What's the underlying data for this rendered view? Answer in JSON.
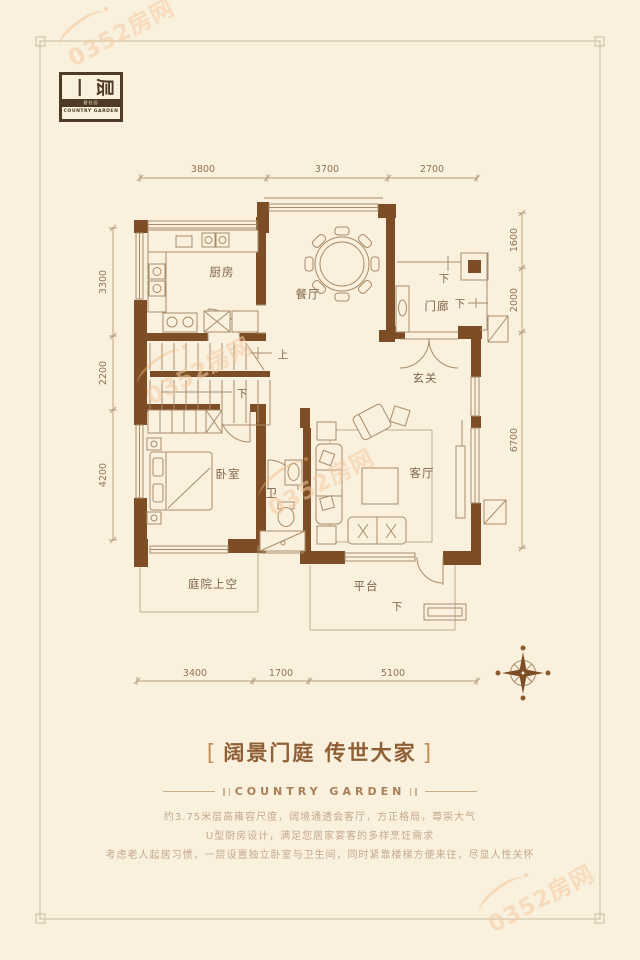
{
  "page": {
    "background": "#FAF0DE",
    "wall_brown": "#7D4E26",
    "title_brown": "#8F5F36",
    "watermark_orange": "#F4CBA2"
  },
  "badge": {
    "floor_chars": [
      "一",
      "层"
    ],
    "brand_cn": "碧桂园",
    "brand_en": "COUNTRY GARDEN"
  },
  "watermark": {
    "text": "0352房网"
  },
  "plan": {
    "rooms": {
      "kitchen": "厨房",
      "dining": "餐厅",
      "porch": "门廊",
      "foyer": "玄关",
      "bedroom": "卧室",
      "bath": "卫",
      "living": "客厅",
      "courtyard": "庭院上空",
      "terrace": "平台"
    },
    "up": "上",
    "down": "下",
    "dims": {
      "top": [
        "3800",
        "3700",
        "2700"
      ],
      "bottom": [
        "3400",
        "1700",
        "5100"
      ],
      "left": [
        "3300",
        "2200",
        "4200"
      ],
      "right": [
        "1600",
        "2000",
        "6700"
      ]
    }
  },
  "footer": {
    "bracket_left": "[",
    "bracket_right": "]",
    "title": "阔景门庭 传世大家",
    "subtitle": "COUNTRY GARDEN",
    "desc": [
      "约3.75米层高雍容尺度，阔境通透会客厅，方正格局，尊崇大气",
      "U型厨房设计，满足您居家宴客的多样烹饪需求",
      "考虑老人起居习惯，一层设置独立卧室与卫生间，同时紧靠楼梯方便来往，尽显人性关怀"
    ]
  }
}
